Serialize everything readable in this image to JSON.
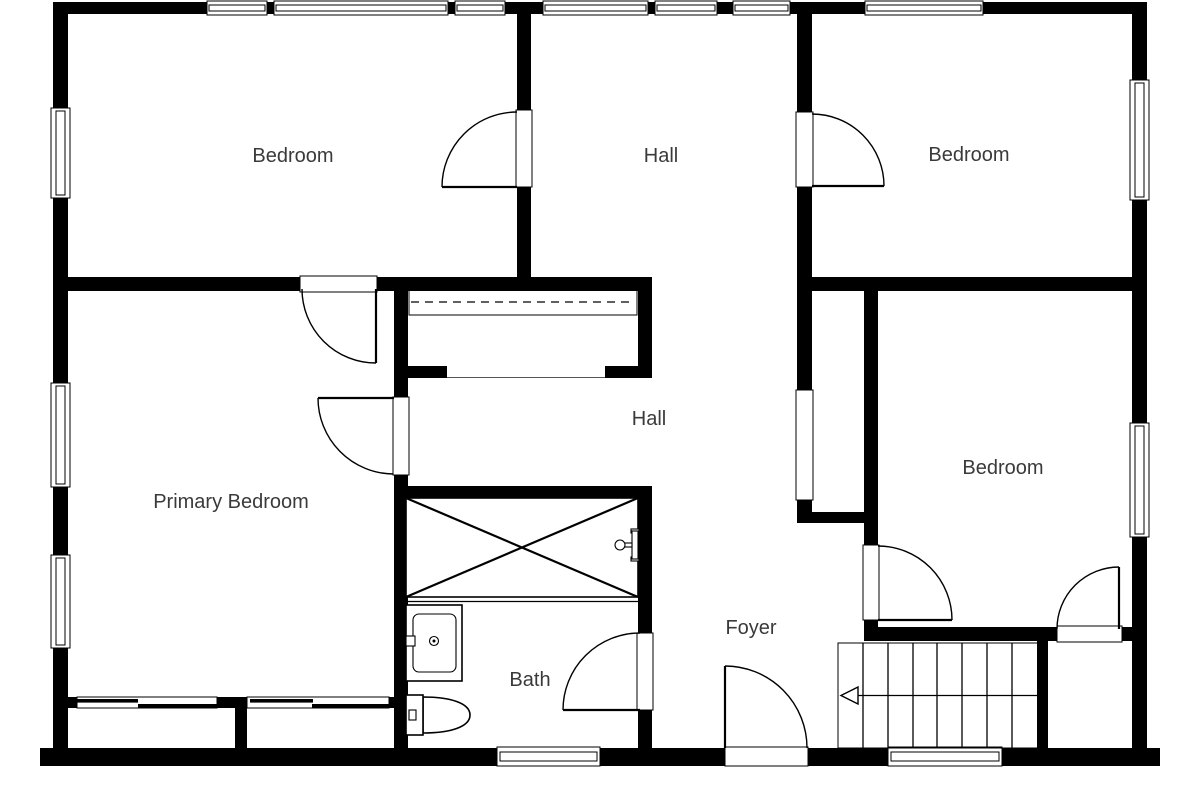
{
  "floorplan": {
    "background_color": "#ffffff",
    "wall_color": "#000000",
    "label_color": "#3a3a3a",
    "rooms": [
      {
        "id": "bedroom-top-left",
        "label": "Bedroom",
        "x": 293,
        "y": 162
      },
      {
        "id": "hall-upper",
        "label": "Hall",
        "x": 661,
        "y": 162
      },
      {
        "id": "bedroom-top-right",
        "label": "Bedroom",
        "x": 969,
        "y": 161
      },
      {
        "id": "primary-bedroom",
        "label": "Primary Bedroom",
        "x": 231,
        "y": 508
      },
      {
        "id": "hall-lower",
        "label": "Hall",
        "x": 649,
        "y": 425
      },
      {
        "id": "bedroom-right",
        "label": "Bedroom",
        "x": 1003,
        "y": 474
      },
      {
        "id": "bath",
        "label": "Bath",
        "x": 530,
        "y": 686
      },
      {
        "id": "foyer",
        "label": "Foyer",
        "x": 751,
        "y": 634
      }
    ],
    "stairs": {
      "arrow_direction": "left",
      "tread_count": 8
    },
    "fixtures": [
      "bathtub-with-cross",
      "tub-faucet",
      "vanity-sink",
      "toilet",
      "staircase",
      "closet-shelf-with-rod",
      "sliding-closet-doors",
      "hinged-doors"
    ],
    "door_count": 8,
    "window_count": 14
  }
}
